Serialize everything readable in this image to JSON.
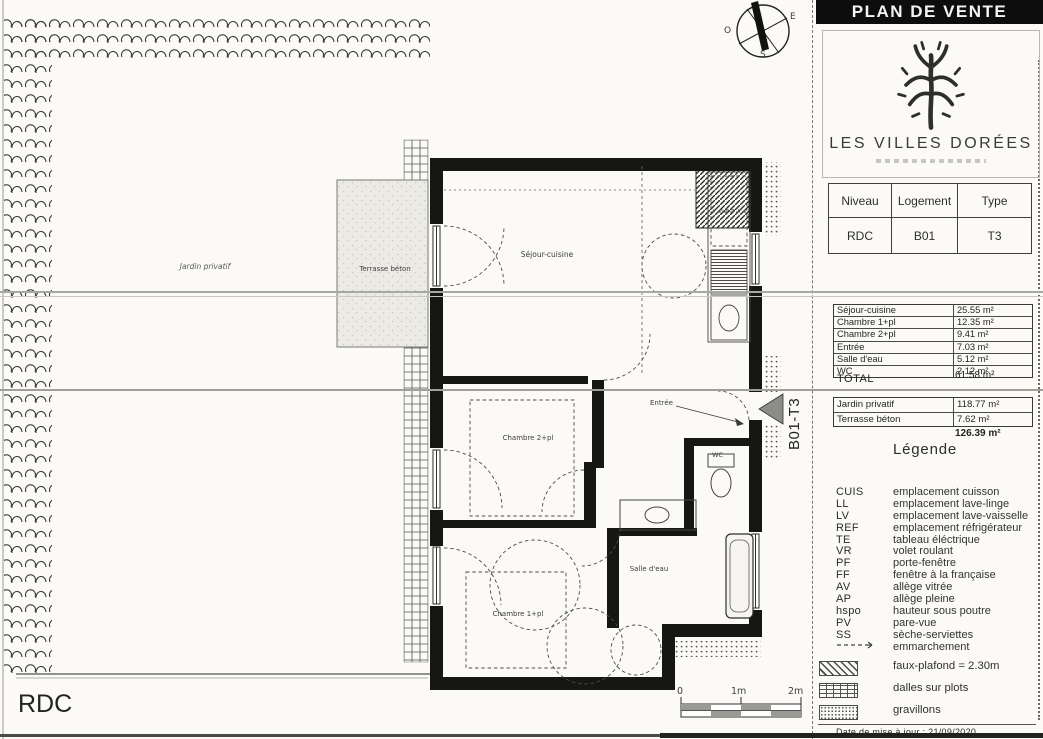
{
  "header": {
    "title": "PLAN DE VENTE"
  },
  "brand": {
    "name": "LES VILLES DORÉES"
  },
  "info_table": {
    "columns": [
      "Niveau",
      "Logement",
      "Type"
    ],
    "values": [
      "RDC",
      "B01",
      "T3"
    ]
  },
  "surfaces": {
    "rows": [
      {
        "label": "Séjour-cuisine",
        "value": "25.55 m²"
      },
      {
        "label": "Chambre 1+pl",
        "value": "12.35 m²"
      },
      {
        "label": "Chambre 2+pl",
        "value": "9.41 m²"
      },
      {
        "label": "Entrée",
        "value": "7.03 m²"
      },
      {
        "label": "Salle d'eau",
        "value": "5.12 m²"
      },
      {
        "label": "WC",
        "value": "2.12 m²"
      }
    ],
    "total_label": "TOTAL",
    "total_value": "61.58 m²"
  },
  "exterior": {
    "rows": [
      {
        "label": "Jardin privatif",
        "value": "118.77 m²"
      },
      {
        "label": "Terrasse béton",
        "value": "7.62 m²"
      }
    ],
    "total_value": "126.39 m²"
  },
  "legend": {
    "title": "Légende",
    "items": [
      {
        "abbr": "CUIS",
        "label": "emplacement cuisson"
      },
      {
        "abbr": "LL",
        "label": "emplacement lave-linge"
      },
      {
        "abbr": "LV",
        "label": "emplacement lave-vaisselle"
      },
      {
        "abbr": "REF",
        "label": "emplacement réfrigérateur"
      },
      {
        "abbr": "TE",
        "label": "tableau éléctrique"
      },
      {
        "abbr": "VR",
        "label": "volet roulant"
      },
      {
        "abbr": "PF",
        "label": "porte-fenêtre"
      },
      {
        "abbr": "FF",
        "label": "fenêtre à la française"
      },
      {
        "abbr": "AV",
        "label": "allège vitrée"
      },
      {
        "abbr": "AP",
        "label": "allège pleine"
      },
      {
        "abbr": "hspo",
        "label": "hauteur sous poutre"
      },
      {
        "abbr": "PV",
        "label": "pare-vue"
      },
      {
        "abbr": "SS",
        "label": "sèche-serviettes"
      }
    ],
    "emmarchement_label": "emmarchement"
  },
  "hatch_legend": [
    {
      "label": "faux-plafond = 2.30m"
    },
    {
      "label": "dalles sur plots"
    },
    {
      "label": "gravillons"
    }
  ],
  "footer": {
    "date": "Date de mise à jour : 21/09/2020"
  },
  "plan": {
    "level": "RDC",
    "unit": "B01-T3",
    "rooms": {
      "jardin": "Jardin privatif",
      "terrasse": "Terrasse béton",
      "sejour": "Séjour-cuisine",
      "chambre2": "Chambre 2+pl",
      "chambre1": "Chambre 1+pl",
      "entree": "Entrée",
      "salle_eau": "Salle d'eau",
      "wc": "WC"
    }
  },
  "compass": {
    "west": "O",
    "east": "E",
    "south": "S"
  },
  "scalebar": {
    "t0": "0",
    "t1": "1m",
    "t2": "2m"
  },
  "colors": {
    "ink": "#161616",
    "paper": "#fbfaf6",
    "banner": "#0d0d0d"
  }
}
